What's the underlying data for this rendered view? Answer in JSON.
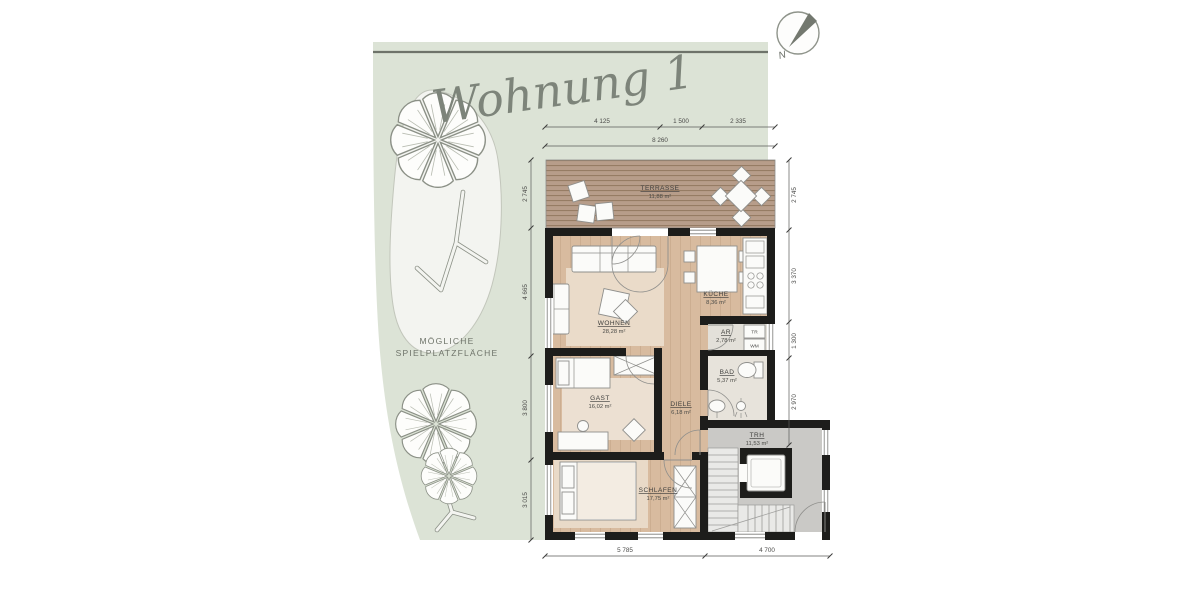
{
  "title": "Wohnung 1",
  "compass": {
    "north_label": "N"
  },
  "garden": {
    "label_line1": "MÖGLICHE",
    "label_line2": "SPIELPLATZFLÄCHE"
  },
  "rooms": {
    "terrasse": {
      "name": "TERRASSE",
      "area": "11,88 m²"
    },
    "wohnen": {
      "name": "WOHNEN",
      "area": "28,28 m²"
    },
    "kueche": {
      "name": "KÜCHE",
      "area": "8,36 m²"
    },
    "ar": {
      "name": "AR",
      "area": "2,78 m²"
    },
    "bad": {
      "name": "BAD",
      "area": "5,37 m²"
    },
    "gast": {
      "name": "GAST",
      "area": "16,02 m²"
    },
    "diele": {
      "name": "DIELE",
      "area": "6,18 m²"
    },
    "schlafen": {
      "name": "SCHLAFEN",
      "area": "17,75 m²"
    },
    "trh": {
      "name": "TRH",
      "area": "11,53 m²"
    }
  },
  "appliances": {
    "dryer_label": "TR",
    "washer_label": "WM"
  },
  "dimensions": {
    "top_segments": [
      "4 125",
      "1 500",
      "2 335"
    ],
    "top_total": "8 260",
    "left": [
      "2 745",
      "4 665",
      "3 800",
      "3 015"
    ],
    "right": [
      "2 745",
      "3 370",
      "1 300",
      "2 970"
    ],
    "bottom": [
      "5 785",
      "4 700"
    ]
  },
  "colors": {
    "garden": "#dce3d6",
    "terrace_wood": "#b79d8a",
    "floor_wood": "#d8bb9f",
    "rug": "#ecdfcf",
    "stairwell_floor": "#cac9c6",
    "wall": "#1d1d1b",
    "title_ink": "#7d847a"
  }
}
